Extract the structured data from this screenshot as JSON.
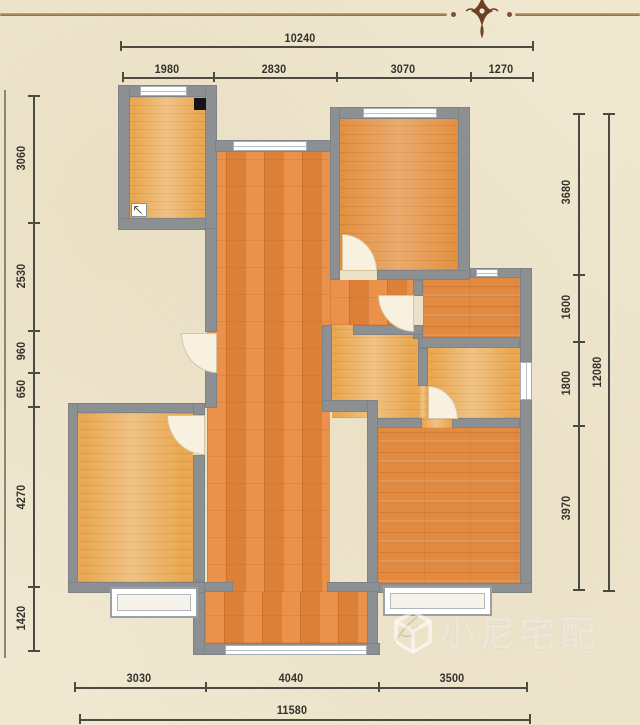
{
  "dims": {
    "top_total": "10240",
    "top_segments": [
      "1980",
      "2830",
      "3070",
      "1270"
    ],
    "left_segments": [
      "3060",
      "2530",
      "960",
      "650",
      "4270",
      "1420"
    ],
    "right_segments": [
      "3680",
      "1600",
      "1800",
      "3970"
    ],
    "right_total": "12080",
    "bottom_segments": [
      "3030",
      "4040",
      "3500"
    ],
    "bottom_total": "11580"
  },
  "watermark": {
    "text": "小尼宅配",
    "logo": "cube-logo"
  },
  "icons": {
    "header_ornament": "header-flourish",
    "flue": "flue-black-square",
    "drain": "floor-drain-icon",
    "plant": "plant-decor"
  },
  "colors": {
    "background": "#f0e8d1",
    "wall_gray": "#8d9093",
    "floor_orange": "#e8873a",
    "floor_tan": "#e9a851",
    "dimension_text": "#33332c",
    "ornament_brown": "#6e4023",
    "watermark_white": "rgba(255,255,255,0.55)"
  }
}
